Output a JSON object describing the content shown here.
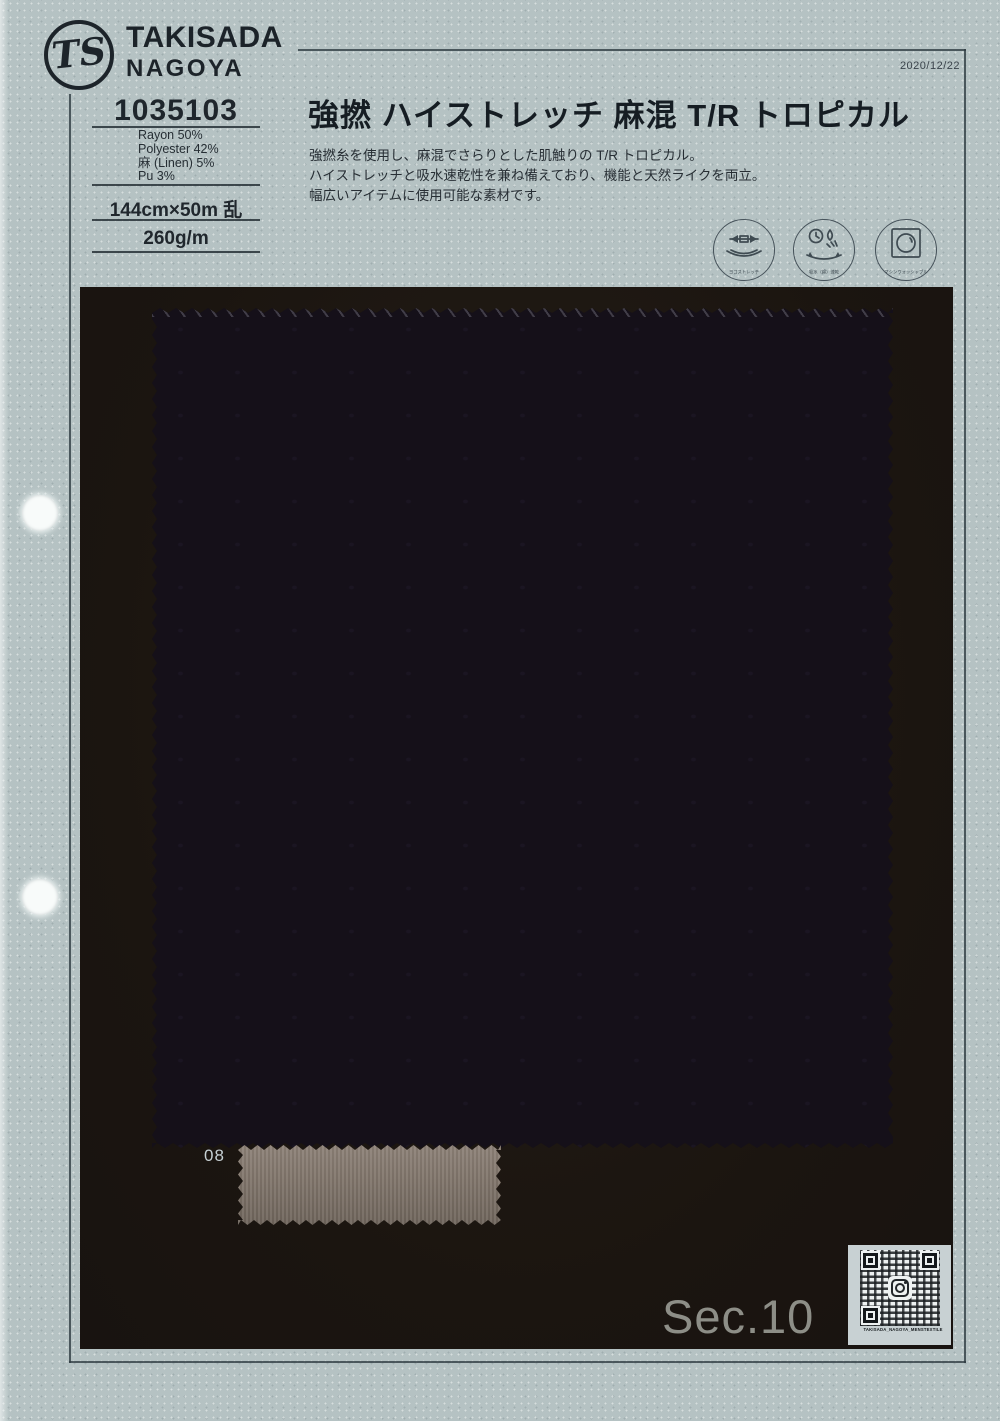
{
  "brand": {
    "monogram": "TS",
    "name_line1": "TAKISADA",
    "name_line2": "NAGOYA"
  },
  "header": {
    "date": "2020/12/22"
  },
  "product": {
    "number": "1035103",
    "composition": [
      "Rayon 50%",
      "Polyester 42%",
      "麻 (Linen) 5%",
      "Pu 3%"
    ],
    "width_length": "144cm×50m 乱",
    "weight": "260g/m",
    "title": "強撚 ハイストレッチ 麻混 T/R トロピカル",
    "description_lines": [
      "強撚糸を使用し、麻混でさらりとした肌触りの T/R トロピカル。",
      "ハイストレッチと吸水速乾性を兼ね備えており、機能と天然ライクを両立。",
      "幅広いアイテムに使用可能な素材です。"
    ]
  },
  "feature_icons": [
    {
      "name": "yoko-stretch-icon",
      "label": "ヨコストレッチ"
    },
    {
      "name": "absorbent-quick-dry-icon",
      "label": "吸水（綿）速乾"
    },
    {
      "name": "machine-washable-icon",
      "label": "マシンウォッシャブル"
    }
  ],
  "swatch": {
    "color_number": "08",
    "fabric_color": "#151019",
    "mount_color": "#1c1611",
    "chip_color": "#81756a"
  },
  "footer": {
    "section_label": "Sec.10",
    "qr_caption": "TAKISADA_NAGOYA_MENSTEXTILE"
  }
}
